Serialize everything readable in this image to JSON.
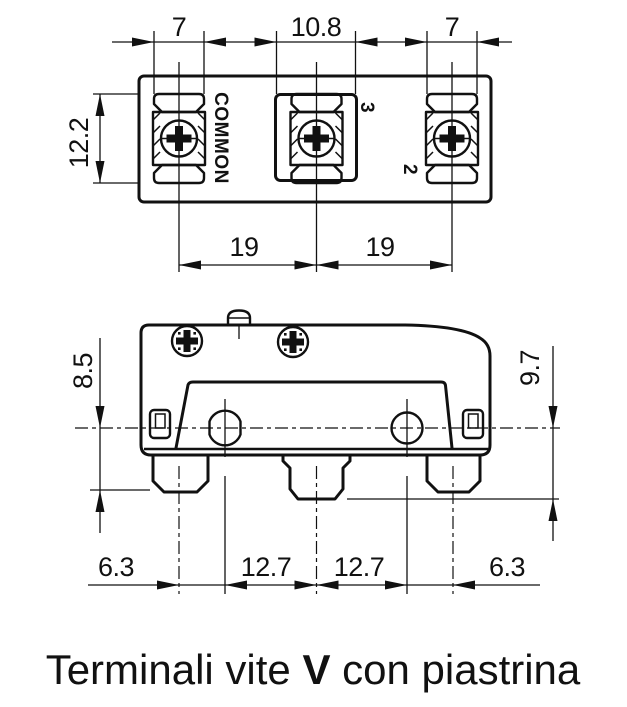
{
  "top_view": {
    "dims": {
      "plate_left": "7",
      "center_box": "10.8",
      "plate_right": "7",
      "height": "12.2",
      "pitch_left": "19",
      "pitch_right": "19"
    },
    "terminals": {
      "left": "COMMON",
      "middle": "3",
      "right": "2"
    }
  },
  "front_view": {
    "dims": {
      "height_left": "8.5",
      "height_right": "9.7",
      "bottom": [
        "6.3",
        "12.7",
        "12.7",
        "6.3"
      ]
    }
  },
  "caption": {
    "prefix": "Terminali vite ",
    "bold": "V",
    "suffix": " con piastrina"
  },
  "colors": {
    "line": "#111111",
    "background": "#ffffff"
  }
}
